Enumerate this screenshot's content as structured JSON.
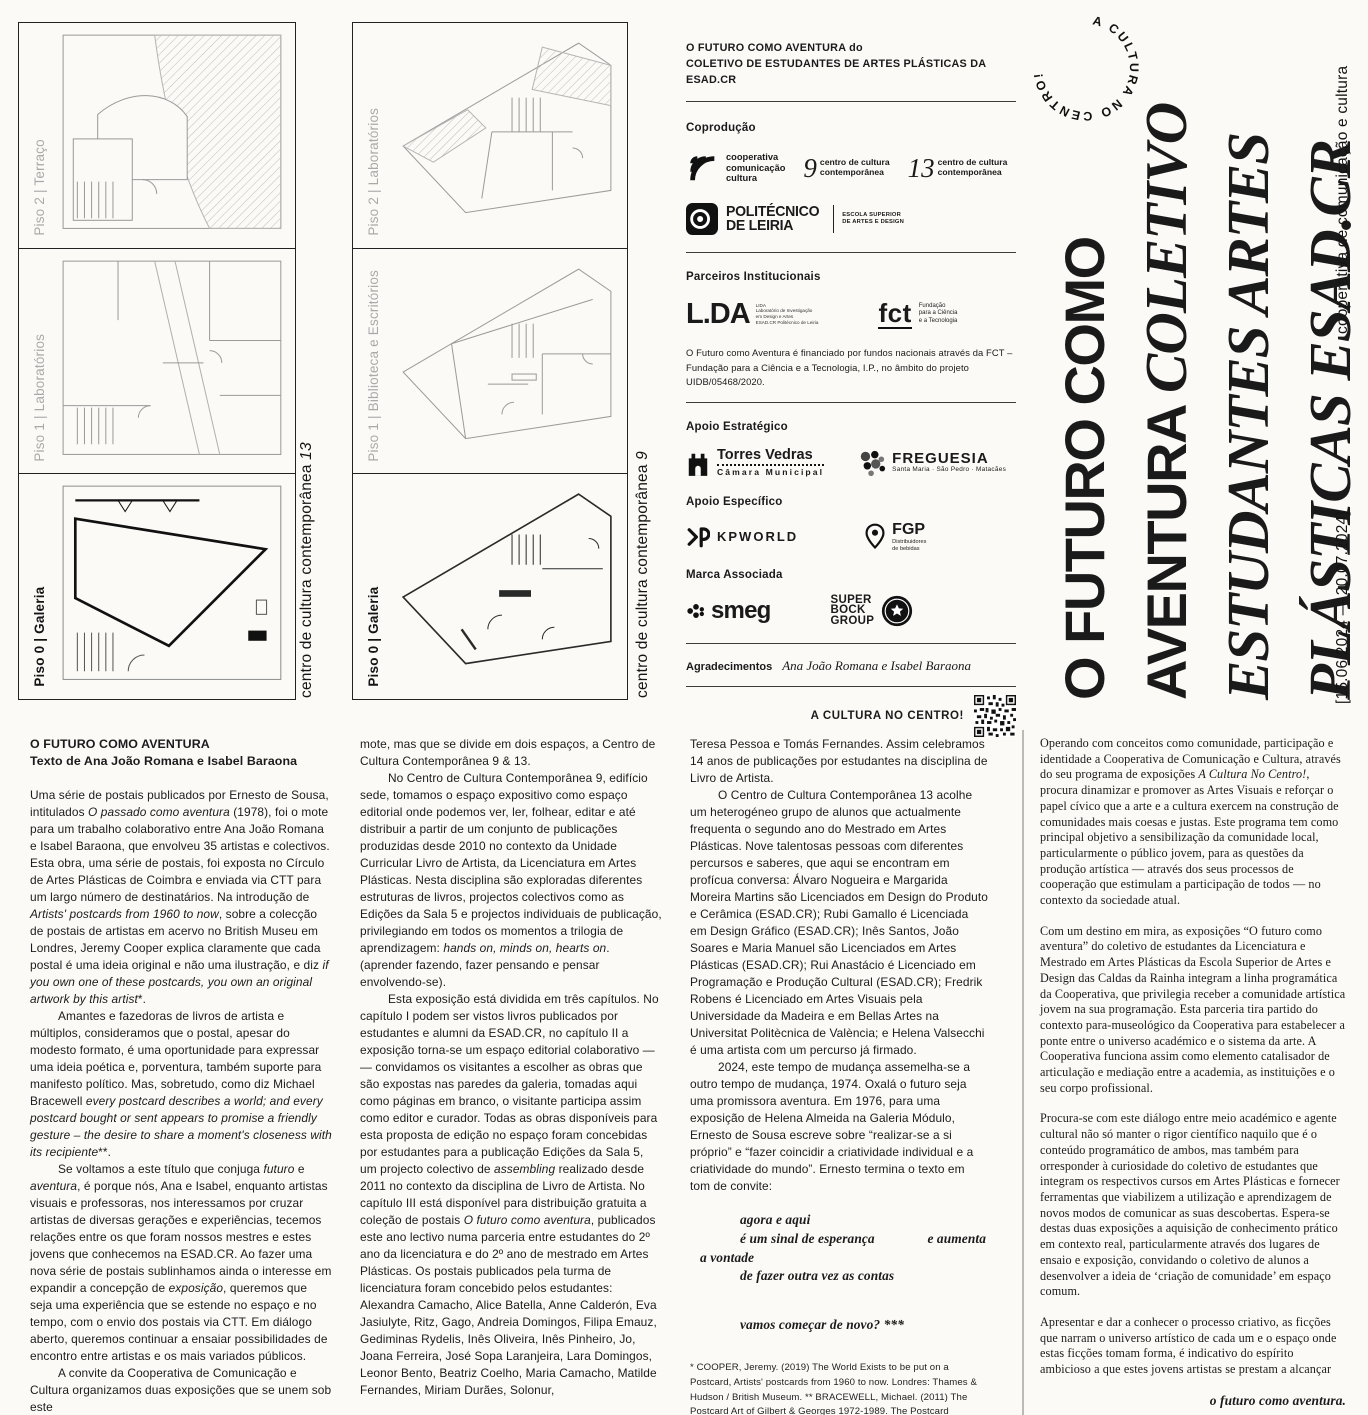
{
  "panel13": {
    "side_caption": "centro de cultura contemporânea ",
    "side_caption_num": "13",
    "floors": [
      {
        "label": "Piso 2 | Terraço"
      },
      {
        "label": "Piso 1 | Laboratórios"
      },
      {
        "label": "Piso 0 | Galeria"
      }
    ]
  },
  "panel9": {
    "side_caption": "centro de cultura contemporânea ",
    "side_caption_num": "9",
    "floors": [
      {
        "label": "Piso 2 | Laboratórios"
      },
      {
        "label": "Piso 1 | Biblioteca e Escritórios"
      },
      {
        "label": "Piso 0 | Galeria"
      }
    ]
  },
  "credits": {
    "header_line1": "O FUTURO COMO AVENTURA do",
    "header_line2": "COLETIVO DE ESTUDANTES DE ARTES PLÁSTICAS DA ESAD.CR",
    "coproducao_label": "Coprodução",
    "coop_l1": "cooperativa",
    "coop_l2": "comunicação",
    "coop_l3": "cultura",
    "ccc9_num": "9",
    "ccc9_l1": "centro de cultura",
    "ccc9_l2": "contemporânea",
    "ccc13_num": "13",
    "ccc13_l1": "centro de cultura",
    "ccc13_l2": "contemporânea",
    "poli_l1": "POLITÉCNICO",
    "poli_l2": "DE LEIRIA",
    "poli_l3": "ESCOLA SUPERIOR",
    "poli_l4": "DE ARTES E DESIGN",
    "parceiros_label": "Parceiros Institucionais",
    "lida_main": "L.DA",
    "lida_tiny1": "LIDA",
    "lida_tiny2": "Laboratório de Investigação",
    "lida_tiny3": "em Design e Artes",
    "lida_tiny4": "ESAD.CR Politécnico de Leiria",
    "fct_main": "fct",
    "fct_l1": "Fundação",
    "fct_l2": "para a Ciência",
    "fct_l3": "e a Tecnologia",
    "funding_text": "O Futuro como Aventura é financiado por fundos nacionais através da FCT – Fundação para a Ciência e a Tecnologia, I.P., no âmbito do projeto UIDB/05468/2020.",
    "apoio_estrategico_label": "Apoio Estratégico",
    "torres_l1": "Torres Vedras",
    "torres_l2": "Câmara Municipal",
    "freguesia_l1": "FREGUESIA",
    "freguesia_l2": "Santa Maria · São Pedro · Matacães",
    "apoio_especifico_label": "Apoio Específico",
    "kpworld": "KPWORLD",
    "fgp_l1": "FGP",
    "fgp_l2": "Distribuidores",
    "fgp_l3": "de bebidas",
    "marca_label": "Marca Associada",
    "smeg": "smeg",
    "sb_l1": "SUPER",
    "sb_l2": "BOCK",
    "sb_l3": "GROUP",
    "agradecimentos_label": "Agradecimentos",
    "agradecimentos_names": "Ana João Romana e Isabel Baraona",
    "cultura_centro": "A CULTURA NO CENTRO!"
  },
  "cover": {
    "circle_text": "A CULTURA NO CENTRO!",
    "title1": "O FUTURO COMO",
    "title2a": "AVENTURA ",
    "title2b": "COLETIVO",
    "title3": "ESTUDANTES ARTES",
    "title4": "PLÁSTICAS ESAD.CR",
    "side_top": "cooperativa de comunicação e cultura",
    "dates": "[15.06.2024 — 20.07.2024]"
  },
  "article": {
    "col1": {
      "heading1": "O FUTURO COMO AVENTURA",
      "heading2": "Texto de Ana João Romana e Isabel Baraona",
      "paras": [
        {
          "t": "Uma série de postais publicados por Ernesto de Sousa, intitulados _O passado como aventura_ (1978), foi o mote para um trabalho colaborativo entre Ana João Romana e Isabel Baraona, que envolveu 35 artistas e colectivos. Esta obra, uma série de postais, foi exposta no Círculo de Artes Plásticas de Coimbra e enviada via CTT para um largo número de destinatários. Na introdução de _Artists' postcards from 1960 to now_, sobre a colecção de postais de artistas em acervo no British Museu em Londres, Jeremy Cooper explica claramente que cada postal é uma ideia original e não uma ilustração, e diz _if you own one of these postcards, you own an original artwork by this artist_*.",
          "indent": false
        },
        {
          "t": "Amantes e fazedoras de livros de artista e múltiplos, consideramos que o postal, apesar do modesto formato, é uma oportunidade para expressar uma ideia poética e, porventura, também suporte para manifesto político. Mas, sobretudo, como diz Michael Bracewell _every postcard describes a world; and every postcard bought or sent appears to promise a friendly gesture – the desire to share a moment's closeness with its recipiente_**.",
          "indent": true
        },
        {
          "t": "Se voltamos a este título que conjuga _futuro_ e _aventura_, é porque nós, Ana e Isabel, enquanto artistas visuais e professoras, nos interessamos por cruzar artistas de diversas gerações e experiências, tecemos relações entre os que foram nossos mestres e estes jovens que conhecemos na ESAD.CR. Ao fazer uma nova série de postais sublinhamos ainda o interesse em expandir a concepção de _exposição_, queremos que seja uma experiência que se estende no espaço e no tempo, com o envio dos postais via CTT. Em diálogo aberto, queremos continuar a ensaiar possibilidades de encontro entre artistas e os mais variados públicos.",
          "indent": true
        },
        {
          "t": "A convite da Cooperativa de Comunicação e Cultura organizamos duas exposições que se unem sob este",
          "indent": true
        }
      ]
    },
    "col2": {
      "paras": [
        {
          "t": "mote, mas que se divide em dois espaços, a Centro de Cultura Contemporânea 9 & 13.",
          "indent": false
        },
        {
          "t": "No Centro de Cultura Contemporânea 9, edifício sede, tomamos o espaço expositivo como espaço editorial onde podemos ver, ler, folhear, editar e até distribuir a partir de um conjunto de publicações produzidas desde 2010 no contexto da Unidade Curricular Livro de Artista, da Licenciatura em Artes Plásticas. Nesta disciplina são exploradas diferentes estruturas de livros, projectos colectivos como as Edições da Sala 5 e projectos individuais de publicação, privilegiando em todos os momentos a trilogia de aprendizagem: _hands on, minds on, hearts on_. (aprender fazendo, fazer pensando e pensar envolvendo-se).",
          "indent": true
        },
        {
          "t": "Esta exposição está dividida em três capítulos. No capítulo I podem ser vistos livros publicados por estudantes e alumni da ESAD.CR, no capítulo II a exposição torna-se um espaço editorial colaborativo — — convidamos os visitantes a escolher as obras que são expostas nas paredes da galeria, tomadas aqui como páginas em branco, o visitante participa assim como editor e curador. Todas as obras disponíveis para esta proposta de edição no espaço foram concebidas por estudantes para a publicação Edições da Sala 5, um projecto colectivo de _assembling_ realizado desde 2011 no contexto da disciplina de Livro de Artista. No capítulo III está disponível para distribuição gratuita a coleção de postais _O futuro como aventura_, publicados este ano lectivo numa parceria entre estudantes do 2º ano da licenciatura e do 2º ano de mestrado em Artes Plásticas. Os postais publicados pela turma de licenciatura foram concebido pelos estudantes: Alexandra Camacho, Alice Batella, Anne Calderón, Eva Jasiulyte, Ritz, Gago, Andreia Domingos, Filipa Emauz, Gediminas Rydelis, Inês Oliveira, Inês Pinheiro, Jo, Joana Ferreira, José Sopa Laranjeira, Lara Domingos, Leonor Bento, Beatriz Coelho, Maria Camacho, Matilde Fernandes, Miriam Durães, Solonur,",
          "indent": true
        }
      ]
    },
    "col3": {
      "paras": [
        {
          "t": "Teresa Pessoa e Tomás Fernandes. Assim celebramos 14 anos de publicações por estudantes na disciplina de Livro de Artista.",
          "indent": false
        },
        {
          "t": "O Centro de Cultura Contemporânea 13 acolhe um heterogéneo grupo de alunos que actualmente frequenta o segundo ano do Mestrado em Artes Plásticas. Nove talentosas pessoas com diferentes percursos e saberes, que aqui se encontram em profícua conversa: Álvaro Nogueira e Margarida Moreira Martins são Licenciados em Design do Produto e Cerâmica (ESAD.CR); Rubi Gamallo é Licenciada em Design Gráfico (ESAD.CR); Inês Santos, João Soares e Maria Manuel são Licenciados em Artes Plásticas (ESAD.CR); Rui Anastácio é Licenciado em Programação e Produção Cultural (ESAD.CR); Fredrik Robens é Licenciado em Artes Visuais pela Universidade da Madeira e em Bellas Artes na Universitat Politècnica de València; e Helena Valsecchi é uma artista com um percurso já firmado.",
          "indent": true
        },
        {
          "t": "2024, este tempo de mudança assemelha-se a outro tempo de mudança, 1974. Oxalá o futuro seja uma promissora aventura. Em 1976, para uma exposição de Helena Almeida na Galeria Módulo, Ernesto de Sousa escreve sobre “realizar-se a si próprio” e “fazer coincidir a criatividade individual e a criatividade do mundo”. Ernesto termina o texto em tom de convite:",
          "indent": true
        }
      ],
      "poem": [
        {
          "t": "agora e aqui",
          "cls": "ind"
        },
        {
          "t": "é um sinal de esperança",
          "t2": "e aumenta",
          "cls": "ind spread"
        },
        {
          "t": "a vontade",
          "cls": "small-ind"
        },
        {
          "t": "de fazer outra vez as contas",
          "cls": "ind"
        },
        {
          "t": "",
          "cls": "gap"
        },
        {
          "t": "vamos começar de novo? ***",
          "cls": "ind"
        }
      ],
      "footnotes": "* COOPER, Jeremy. (2019) The World Exists to be put on a Postcard, Artists' postcards from 1960 to now. Londres: Thames & Hudson / British Museum. ** BRACEWELL, Michael. (2011) The Postcard Art of Gilbert & Georges 1972-1989. The Postcard Sculture, Postcard Pieces, Titled Postcards Pictures. Munique: DelMonico Books/Prestel. *** Texto para a exposição homónima de Helena Almeida, Galeria Módulo (Porto), Junho-Julho do ano 1976"
    },
    "col4": {
      "paras": [
        {
          "t": "Operando com conceitos como comunidade, participação e identidade a Cooperativa de Comunicação e Cultura, através do seu programa de exposições _A Cultura No Centro!_, procura dinamizar e promover as Artes Visuais e reforçar o papel cívico que a arte e a cultura exercem na construção de comunidades mais coesas e justas. Este programa tem como principal objetivo a sensibilização da comunidade local, particularmente o público jovem, para as questões da produção artística — através dos seus processos de cooperação que estimulam a participação de todos — no contexto da sociedade atual.",
          "indent": false
        },
        {
          "t": "Com um destino em mira, as exposições “O futuro como aventura” do coletivo de estudantes da Licenciatura e Mestrado em Artes Plásticas da Escola Superior de Artes e Design das Caldas da Rainha integram a linha programática da Cooperativa, que privilegia receber a comunidade artística jovem na sua programação. Esta parceria tira partido do contexto para-museológico da Cooperativa para estabelecer a ponte entre o universo académico e o sistema da arte. A Cooperativa funciona assim como elemento catalisador de articulação e mediação entre a academia, as instituições e o seu corpo profissional.",
          "indent": false
        },
        {
          "t": "Procura-se com este diálogo entre meio académico e agente cultural não só manter o rigor científico naquilo que é o conteúdo programático de ambos, mas também para orresponder à curiosidade do coletivo de estudantes que integram os respectivos cursos em Artes Plásticas e fornecer ferramentas que viabilizem a utilização e aprendizagem de novos modos de comunicar as suas descobertas. Espera-se destas duas exposições a aquisição de conhecimento prático em contexto real, particularmente através dos lugares de ensaio e exposição, convidando o coletivo de alunos a desenvolver a ideia de ‘criação de comunidade’ em espaço comum.",
          "indent": false
        },
        {
          "t": "Apresentar e dar a conhecer o processo criativo, as ficções que narram o universo artístico de cada um e o espaço onde estas ficções tomam forma, é indicativo do espírito ambicioso a que estes jovens artistas se prestam a alcançar",
          "indent": false
        }
      ],
      "tagline": "o futuro como aventura.",
      "sig1": "Pedro Zema",
      "sig2": "Cooperativa de Comunicação e Cultura, 2024"
    }
  }
}
